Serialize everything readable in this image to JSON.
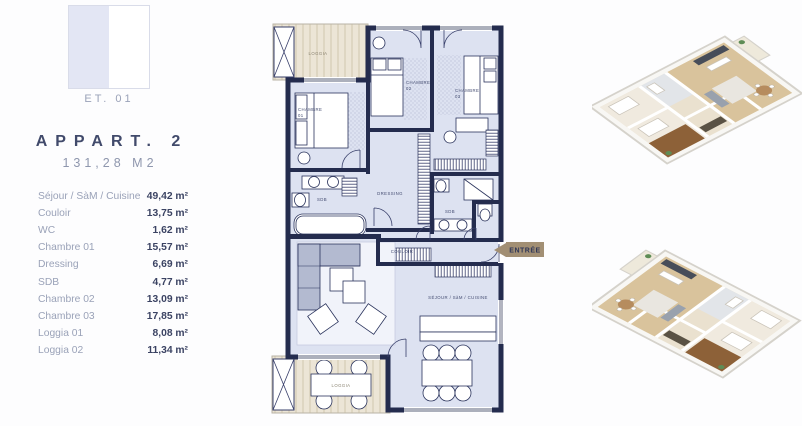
{
  "left_panel": {
    "floor_label": "ET. 01",
    "apartment_title": "APPART. 2",
    "apartment_area": "131,28 M2",
    "rooms": [
      {
        "label": "Séjour / SàM / Cuisine",
        "area": "49,42 m²"
      },
      {
        "label": "Couloir",
        "area": "13,75 m²"
      },
      {
        "label": "WC",
        "area": "1,62 m²"
      },
      {
        "label": "Chambre 01",
        "area": "15,57 m²"
      },
      {
        "label": "Dressing",
        "area": "6,69 m²"
      },
      {
        "label": "SDB",
        "area": "4,77 m²"
      },
      {
        "label": "Chambre 02",
        "area": "13,09 m²"
      },
      {
        "label": "Chambre 03",
        "area": "17,85 m²"
      },
      {
        "label": "Loggia 01",
        "area": "8,08 m²"
      },
      {
        "label": "Loggia 02",
        "area": "11,34 m²"
      }
    ]
  },
  "floor_plan": {
    "labels": {
      "loggia": "LOGGIA",
      "chambre": "CHAMBRE",
      "n01": "01",
      "n02": "02",
      "n03": "03",
      "sdb": "SDB",
      "dressing": "DRESSING",
      "couloir": "COULOIR",
      "sejour": "SÉJOUR / SàM / CUISINE",
      "entree": "ENTRÉE"
    },
    "colors": {
      "wall": "#242c4e",
      "room_fill": "#dde2f1",
      "loggia_fill": "#ece5d6",
      "entree_tag": "#a28f74"
    }
  }
}
